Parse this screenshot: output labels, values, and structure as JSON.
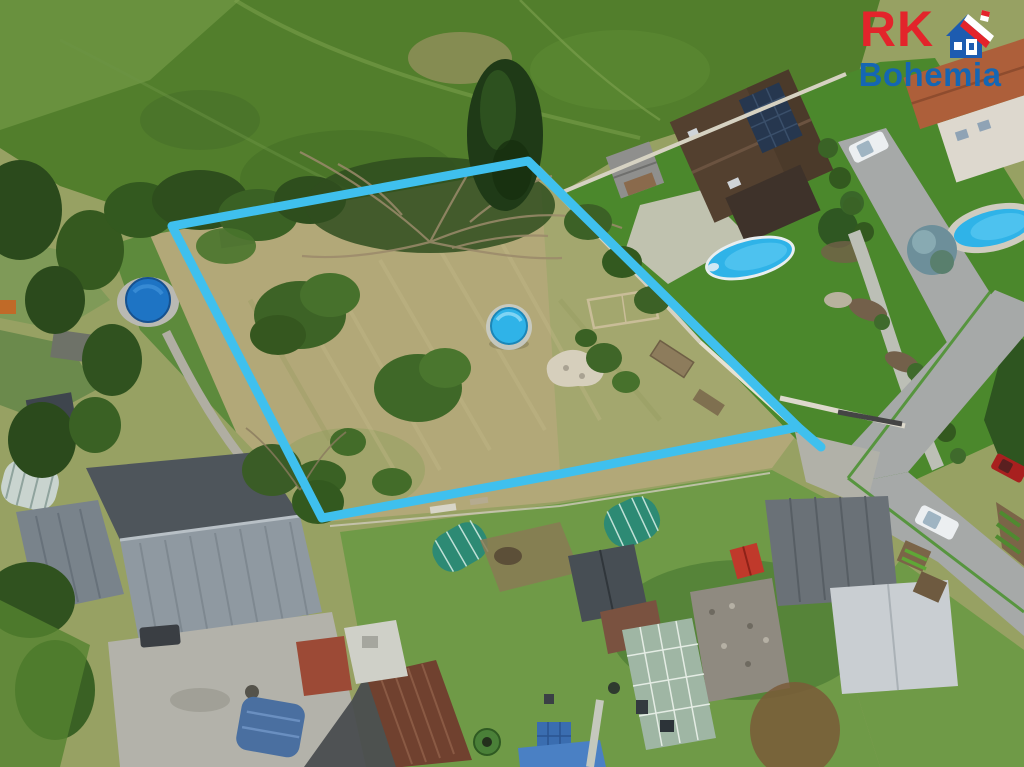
{
  "image": {
    "kind": "aerial-drone-photo",
    "description": "Aerial view of a building plot for sale, marked with a light-blue boundary outline, surrounded by village gardens, sheds, pools and houses",
    "width": 1024,
    "height": 767
  },
  "watermark": {
    "rk_text": "RK",
    "bohemia_text": "Bohemia",
    "rk_color": "#e3242b",
    "bohemia_color": "#1566b3",
    "house_blue": "#1d5cb0",
    "house_red": "#e3242b",
    "house_white": "#ffffff"
  },
  "parcel": {
    "outline_points": "172,226 528,161 798,427 560,474 322,518",
    "tail_x1": "798",
    "tail_y1": "427",
    "tail_x2": "821",
    "tail_y2": "447",
    "outline_color": "#3fc0ee",
    "outline_width": "9"
  },
  "scene": {
    "colors": {
      "base": "#97a163",
      "meadow": "#527e2c",
      "meadow_light": "#6b9440",
      "dry_grass": "#b2a878",
      "lawn": "#4b882c",
      "lawn_mid": "#6f9a47",
      "tree_dark": "#2c4c1d",
      "tree_mid": "#3a6124",
      "conifer": "#1f3a17",
      "roof_brown": "#53402f",
      "roof_dark_brown": "#3e322a",
      "solar_panel": "#26374f",
      "terracotta": "#ad5f3a",
      "wall_white": "#d6d2c2",
      "street_gray": "#a6a9a8",
      "courtyard": "#b3b2aa",
      "roof_steel": "#8f99a1",
      "roof_dark": "#4e555b",
      "roof_red_brown": "#70412f",
      "shed_red": "#c0392b",
      "tunnel_teal": "#2d8a74",
      "greenhouse_glass": "#9fb6a4",
      "stone_roof": "#8f8a80",
      "pool_azure": "#2fb3e8",
      "pool_deep": "#1e74c4",
      "car_white": "#eceff1",
      "car_red": "#a8201f",
      "tarp_blue": "#4a6fa0",
      "path_gray": "#b0aea2",
      "soil": "#8a7a55",
      "mulch": "#73604a",
      "spruce_blue": "#6d8f9a",
      "rubble": "#d6cfbc"
    }
  }
}
